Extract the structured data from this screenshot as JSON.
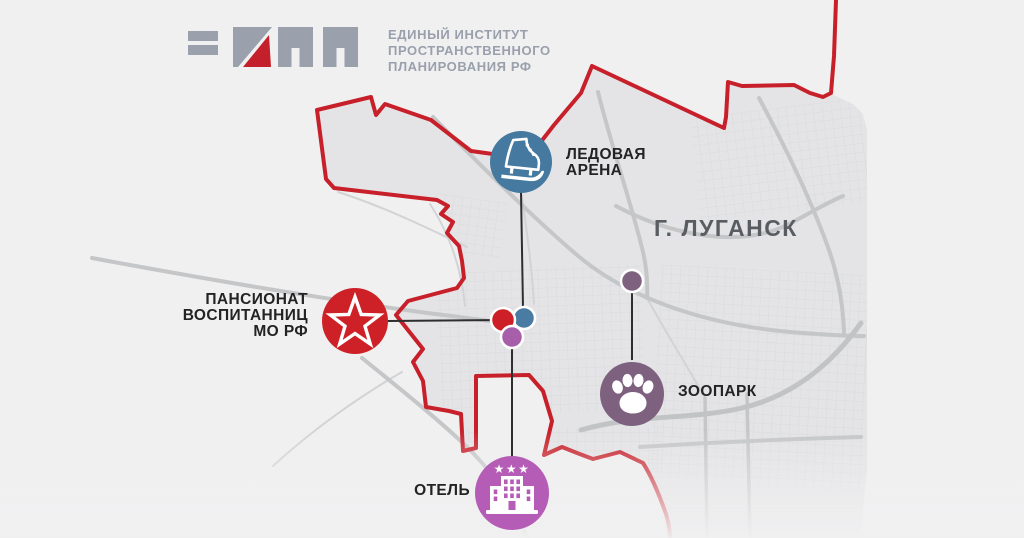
{
  "logo": {
    "org_lines": [
      "ЕДИНЫЙ ИНСТИТУТ",
      "ПРОСТРАНСТВЕННОГО",
      "ПЛАНИРОВАНИЯ РФ"
    ],
    "mark_gray": "#9aa1ad",
    "mark_red": "#c3202b"
  },
  "city": {
    "label": "Г. ЛУГАНСК"
  },
  "markers": {
    "ice_arena": {
      "line1": "ЛЕДОВАЯ",
      "line2": "АРЕНА",
      "color": "#45799f",
      "icon": "ice-skate"
    },
    "pansionat": {
      "line1": "ПАНСИОНАТ",
      "line2": "ВОСПИТАННИЦ",
      "line3": "МО РФ",
      "color": "#ce2127",
      "icon": "army-star"
    },
    "zoo": {
      "label": "ЗООПАРК",
      "color": "#7d617f",
      "icon": "paw"
    },
    "hotel": {
      "label": "ОТЕЛЬ",
      "color": "#b45cb6",
      "icon": "hotel-building"
    }
  },
  "location_dots": {
    "red": "#cc2026",
    "blue": "#4a7ba2",
    "purple": "#a85fa9",
    "zoo": "#7d617f"
  },
  "map_colors": {
    "background": "#f0f0f1",
    "city_fill": "#e4e4e6",
    "boundary": "#c7202a",
    "major_road": "#c5c6c8",
    "minor_road": "#d2d3d5",
    "connector": "#2e2e2e"
  }
}
